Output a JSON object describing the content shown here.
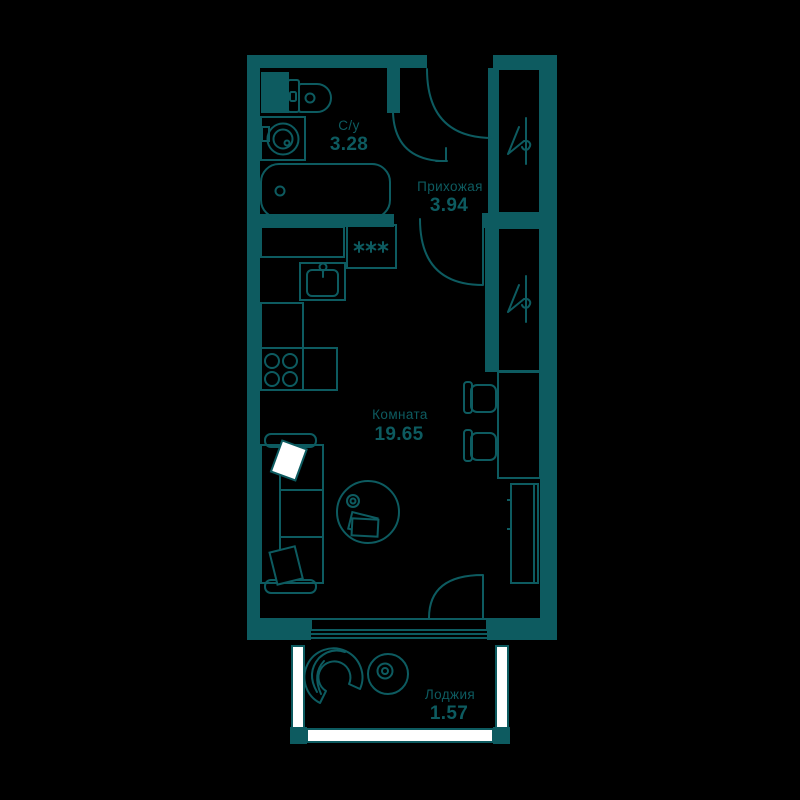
{
  "plan": {
    "type": "apartment-floor-plan",
    "language": "ru",
    "colors": {
      "wall": "#0d5b60",
      "floor": "#000000",
      "window": "#ffffff"
    },
    "rooms": [
      {
        "id": "bathroom",
        "name": "С/у",
        "area": "3.28"
      },
      {
        "id": "hallway",
        "name": "Прихожая",
        "area": "3.94"
      },
      {
        "id": "living-room",
        "name": "Комната",
        "area": "19.65"
      },
      {
        "id": "loggia",
        "name": "Лоджия",
        "area": "1.57"
      }
    ],
    "icons": {
      "wardrobe": "hanger-icon",
      "fridge": "snowflake-icon",
      "fixtures": [
        "toilet",
        "washing-machine",
        "bathtub",
        "kitchen-sink",
        "stove",
        "fridge",
        "wardrobe",
        "wardrobe",
        "desk",
        "chair",
        "chair",
        "tv-stand",
        "sofa",
        "coffee-table",
        "armchair",
        "side-table"
      ]
    }
  }
}
